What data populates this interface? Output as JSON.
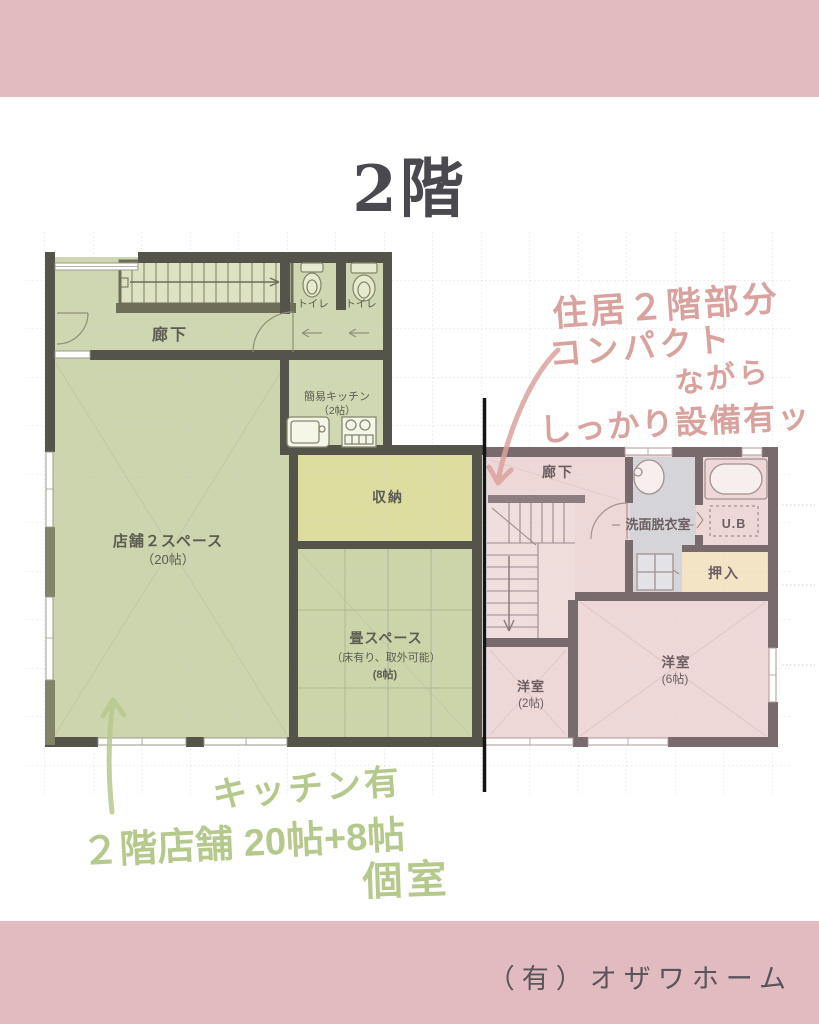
{
  "page": {
    "title": "2階",
    "company": "（有）オザワホーム"
  },
  "colors": {
    "band_pink": "#e1bbbf",
    "green_room": "#ced6b0",
    "storage_yellow": "#dcdd9f",
    "pink_room": "#eed8d7",
    "washroom_gray": "#d5d4d8",
    "closet_tan": "#f2e4c4",
    "wall_green_zone": "#55544a",
    "wall_pink_zone": "#796a6e",
    "handwriting_pink": "#d9a29e",
    "handwriting_green": "#b6c98c",
    "divider_black": "#141414"
  },
  "floor_plan": {
    "rooms": {
      "corridor_left": {
        "label": "廊下"
      },
      "toilet_1": {
        "label": "トイレ"
      },
      "toilet_2": {
        "label": "トイレ"
      },
      "kitchen": {
        "label": "簡易キッチン",
        "size": "（2帖）"
      },
      "shop": {
        "label": "店舗２スペース",
        "size": "（20帖）"
      },
      "storage": {
        "label": "収納"
      },
      "tatami": {
        "label": "畳スペース",
        "note": "（床有り、取外可能）",
        "size": "(8帖)"
      },
      "corridor_right": {
        "label": "廊下"
      },
      "washroom": {
        "label": "洗面脱衣室"
      },
      "unit_bath": {
        "label": "U.B"
      },
      "closet": {
        "label": "押入"
      },
      "western_2": {
        "label": "洋室",
        "size": "(2帖)"
      },
      "western_6": {
        "label": "洋室",
        "size": "(6帖)"
      }
    }
  },
  "annotations": {
    "pink_note": {
      "line1": "住居２階部分",
      "line2": "コンパクト",
      "line3": "ながら",
      "line4": "しっかり設備有ッ"
    },
    "green_note": {
      "line1": "キッチン有",
      "line2": "２階店舗 20帖+8帖",
      "line3": "個室"
    }
  }
}
